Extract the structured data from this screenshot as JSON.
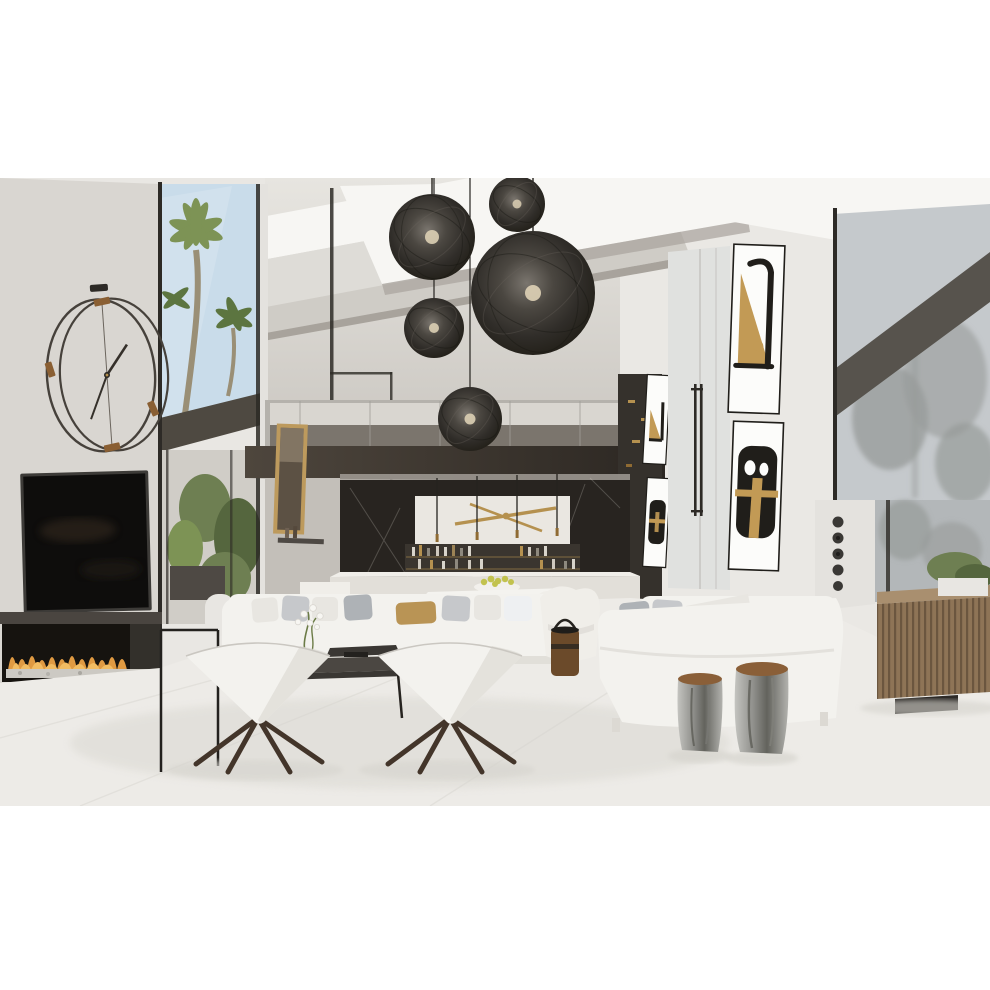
{
  "meta": {
    "type": "interior-photograph",
    "subject": "modern double-height living room render"
  },
  "palette": {
    "page_bg": "#ffffff",
    "wall_left": "#d9d6d1",
    "wall_center_top": "#e4e2dd",
    "wall_center_bottom": "#c7c3bd",
    "wall_right": "#eae8e4",
    "ceiling_base": "#e9e7e3",
    "ceiling_bright": "#f7f6f3",
    "ceiling_band": "#dedcd7",
    "ceiling_shade": "#cfccc6",
    "ceiling_crease": "#a8a39c",
    "sky": "#c9dcea",
    "palm": "#7d9355",
    "palm_dark": "#5c7540",
    "trunk": "#9a8f76",
    "frame_dark": "#2d2a26",
    "overhang": "#4e4941",
    "interior_room": "#d0cdc7",
    "interior_dark": "#4e4944",
    "mezz_glass": "#b5b2ac",
    "mezz_cabinet": "#d9d6d0",
    "mezz_shelf": "#7b756d",
    "mezz_chair": "#57524c",
    "fascia": "#473f37",
    "fascia_dark": "#2e2a25",
    "dark_unit": "#35312c",
    "marble": "#282420",
    "marble_vein": "#e8e4da",
    "cabinet_white": "#eae7e1",
    "gold": "#b5914f",
    "gold_dark": "#8f6b33",
    "shelf_dark": "#3a352f",
    "counter_top": "#f0eee9",
    "counter_front": "#e2dfd9",
    "table_white": "#f4f3ef",
    "fruit": "#c2c24e",
    "chair_dark": "#2e2b27",
    "chair_white": "#f0eee9",
    "glass_right": "#c5c9cc",
    "glass_right_low": "#b3b7b9",
    "tree": "#979b99",
    "beam": "#57534d",
    "pillar": "#e4e2de",
    "speaker_dark": "#3a3835",
    "sideboard": "#8e7456",
    "slat": "#6b563f",
    "plinth": "#2e2b28",
    "plant": "#6e7f52",
    "plant_dark": "#55663e",
    "planter": "#e8e6e2",
    "tv_black": "#0e0d0c",
    "tv_frame": "#3d3b38",
    "fire_band": "#4a4540",
    "fire_dark": "#16130f",
    "flame": "#e09a42",
    "flame_bright": "#f2bc62",
    "pebble": "#ccc9c3",
    "clock_ring": "#46413b",
    "clock_tab": "#8a5f33",
    "clock_hand": "#35302a",
    "pendant_edge": "#232019",
    "bulb": "#dccfb4",
    "cord": "#26231f",
    "sofa": "#f3f2ee",
    "sofa_shade": "#dcd9d3",
    "pillow_gray": "#c6c8cb",
    "pillow_gray_dark": "#aeb2b6",
    "pillow_gold": "#b99455",
    "pillow_light": "#e8e6e1",
    "table_dark": "#3a3733",
    "table_dark_top": "#4b4742",
    "bucket": "#6b4a2a",
    "stool_leg": "#43352a",
    "stump": "#acaca8",
    "stump_dark": "#63635d",
    "stump_top": "#8a5f38",
    "floor": "#edebe7",
    "floor_shadow": "#dddbd5",
    "shadow": "#d6d4ce",
    "art_white": "#fcfcfa",
    "art_black": "#201e1a",
    "art_gold": "#c29a55",
    "door": "#e0e1df",
    "door_seam": "#c6c4c0",
    "mirror_gold": "#bd9a5d",
    "mirror_glass": "#5c5144"
  },
  "scene": {
    "objects": [
      "wire-sphere-pendant-lights",
      "double-ring-wall-clock",
      "wall-mounted-tv",
      "linear-fireplace",
      "floor-to-ceiling-windows",
      "palm-trees",
      "mezzanine-glass-balustrade",
      "dark-marble-bar-wall",
      "floating-bar-cabinet-gold-sculpture",
      "bottle-shelves",
      "bar-counter-stools",
      "dining-table-fruit-bowl",
      "gold-framed-mirror",
      "white-modular-sofa",
      "decorative-pillows",
      "orchid-centerpiece",
      "dark-coffee-tables",
      "leather-bucket-side-table",
      "white-cone-swivel-stools",
      "white-lounge-chair",
      "white-chaise-sofa",
      "silver-tree-stump-tables",
      "abstract-wall-art-set",
      "glass-door-pull-handles",
      "floor-standing-speaker",
      "slatted-wood-sideboard",
      "potted-plants",
      "light-stone-floor"
    ]
  }
}
